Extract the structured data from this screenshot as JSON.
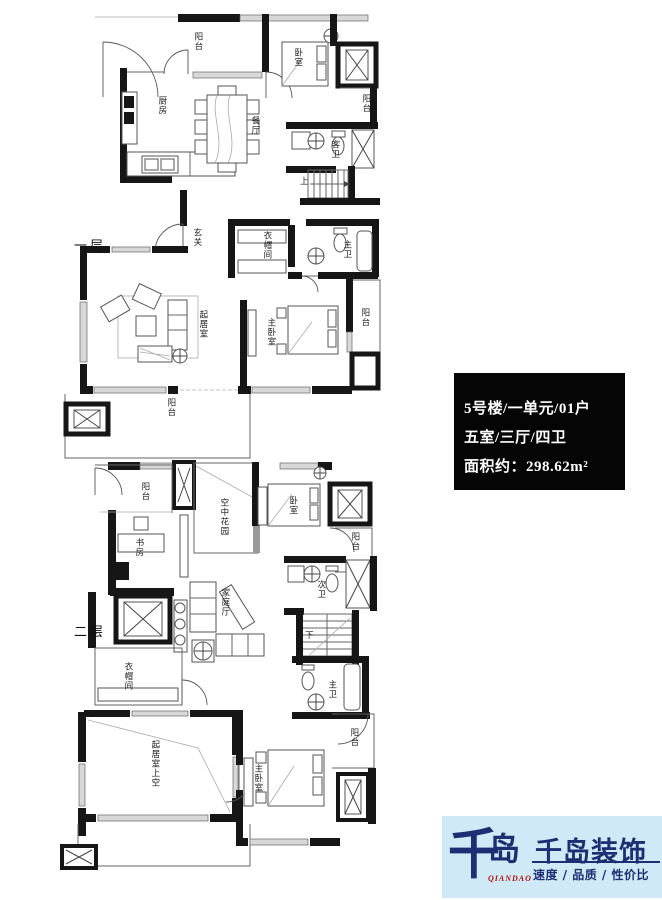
{
  "info_box": {
    "building": "5号楼/一单元/01户",
    "rooms": "五室/三厅/四卫",
    "area": "面积约：298.62m²"
  },
  "floor1": {
    "name": "一层",
    "labels": [
      {
        "text": "阳台"
      },
      {
        "text": "卧室"
      },
      {
        "text": "厨房"
      },
      {
        "text": "餐厅"
      },
      {
        "text": "阳台"
      },
      {
        "text": "客卫"
      },
      {
        "text": "上"
      },
      {
        "text": "玄关"
      },
      {
        "text": "衣帽间"
      },
      {
        "text": "主卫"
      },
      {
        "text": "起居室"
      },
      {
        "text": "主卧室"
      },
      {
        "text": "阳台"
      },
      {
        "text": "阳台"
      }
    ]
  },
  "floor2": {
    "name": "二层",
    "labels": [
      {
        "text": "阳台"
      },
      {
        "text": "空中花园"
      },
      {
        "text": "卧室"
      },
      {
        "text": "阳台"
      },
      {
        "text": "书房"
      },
      {
        "text": "次卫"
      },
      {
        "text": "家庭厅"
      },
      {
        "text": "下"
      },
      {
        "text": "衣帽间"
      },
      {
        "text": "主卫"
      },
      {
        "text": "起居室上空"
      },
      {
        "text": "主卧室"
      },
      {
        "text": "阳台"
      }
    ]
  },
  "logo": {
    "mark": "千岛",
    "mark_char1": "千",
    "mark_char2": "岛",
    "mark_caption": "QIANDAO",
    "title": "千岛装饰",
    "tagline": "速度 / 品质 / 性价比"
  },
  "colors": {
    "wall": "#161616",
    "info_bg": "#050505",
    "info_text": "#ffffff",
    "logo_navy": "#1d2e72",
    "logo_bg": "#cfeaf6",
    "logo_red": "#b01212"
  }
}
